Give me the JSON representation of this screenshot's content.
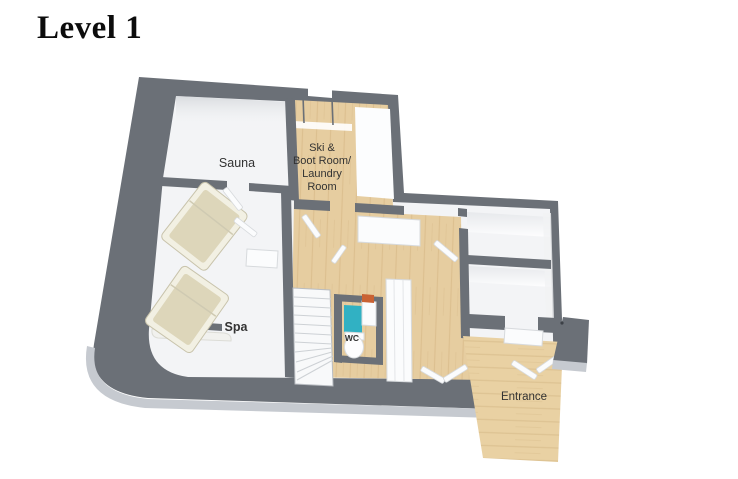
{
  "page": {
    "title": "Level 1"
  },
  "theme": {
    "wall": "#6b7077",
    "wallLight": "#c6cad0",
    "wood": "#e6cda0",
    "porchWood": "#e9d1a3",
    "floor": "#f3f4f6",
    "teal": "#31b1c3",
    "orange": "#c96233",
    "label": "#333333",
    "title": "#0c0c0c"
  },
  "floorplan": {
    "rooms": {
      "sauna": {
        "label": "Sauna"
      },
      "ski_boot_laundry": {
        "label_lines": [
          "Ski &",
          "Boot Room/",
          "Laundry",
          "Room"
        ]
      },
      "spa": {
        "label": "Spa"
      },
      "wc": {
        "label": "WC"
      },
      "entrance": {
        "label": "Entrance"
      }
    }
  }
}
